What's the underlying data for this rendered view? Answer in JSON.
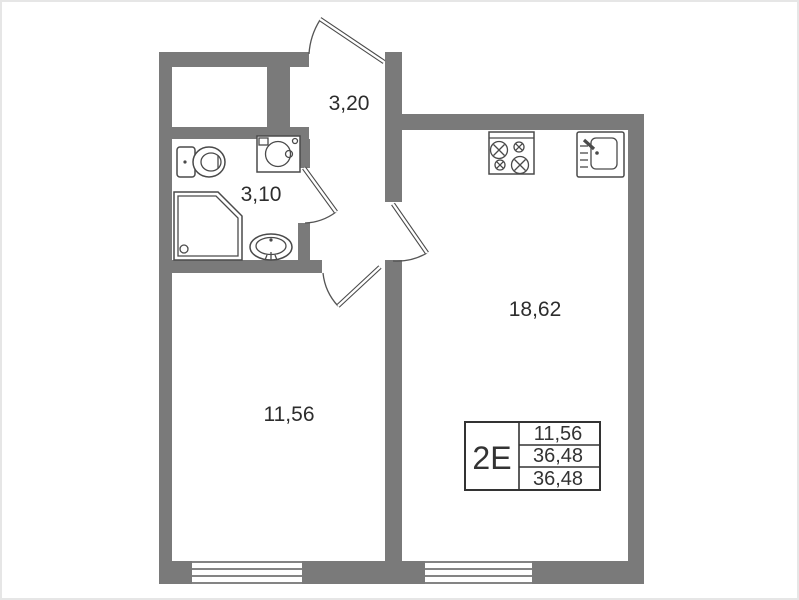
{
  "page": {
    "background": "#ffffff",
    "frame_color": "#e6e6e6"
  },
  "plan": {
    "colors": {
      "wall": "#7a7a7a",
      "outline": "#4a4a4a",
      "label_text": "#2d2d2d"
    },
    "rooms": [
      {
        "id": "hallway",
        "area": "3,20"
      },
      {
        "id": "bathroom",
        "area": "3,10"
      },
      {
        "id": "kitchen-living-room",
        "area": "18,62"
      },
      {
        "id": "bedroom",
        "area": "11,56"
      }
    ],
    "fixture_icons": [
      "toilet-icon",
      "washing-machine-icon",
      "shower-icon",
      "bathroom-sink-icon",
      "stove-icon",
      "kitchen-sink-icon"
    ],
    "windows_count": 2,
    "doors_count": 4,
    "stamp": {
      "unit_type": "2Е",
      "rows": [
        "11,56",
        "36,48",
        "36,48"
      ]
    }
  }
}
